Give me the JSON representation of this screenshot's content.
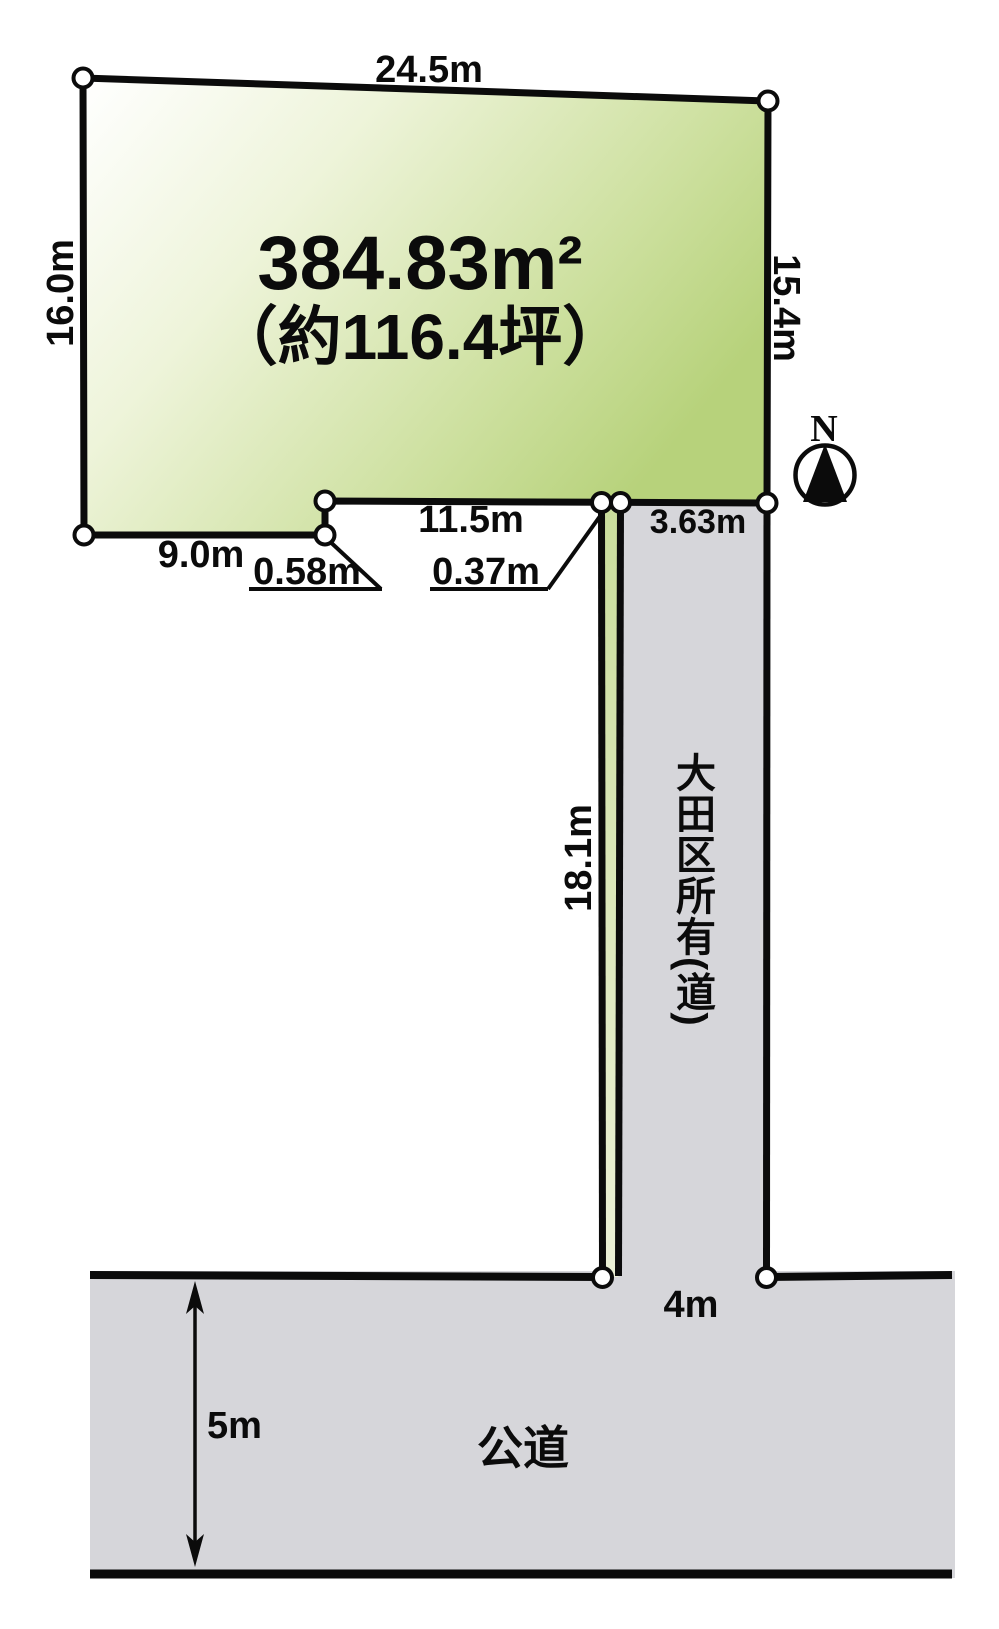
{
  "plot": {
    "area_label": "384.83m²",
    "area_tsubo_label": "（約116.4坪）",
    "dimensions": {
      "top": "24.5m",
      "left": "16.0m",
      "right": "15.4m",
      "bottom_left": "9.0m",
      "bottom_middle": "11.5m",
      "setback_step": "0.58m",
      "strip_width": "0.37m"
    }
  },
  "private_road": {
    "label": "大田区所有(道)",
    "width_top": "3.63m",
    "length": "18.1m",
    "width_bottom": "4m"
  },
  "public_road": {
    "label": "公道",
    "width": "5m"
  },
  "compass": {
    "north_label": "N"
  },
  "colors": {
    "plot_fill_start": "#ffffff",
    "plot_fill_end": "#b7d27b",
    "strip_fill_top": "#cadd9c",
    "strip_fill_bottom": "#ecf1d7",
    "road_fill": "#d6d6da",
    "outline": "#0b0b0b"
  }
}
